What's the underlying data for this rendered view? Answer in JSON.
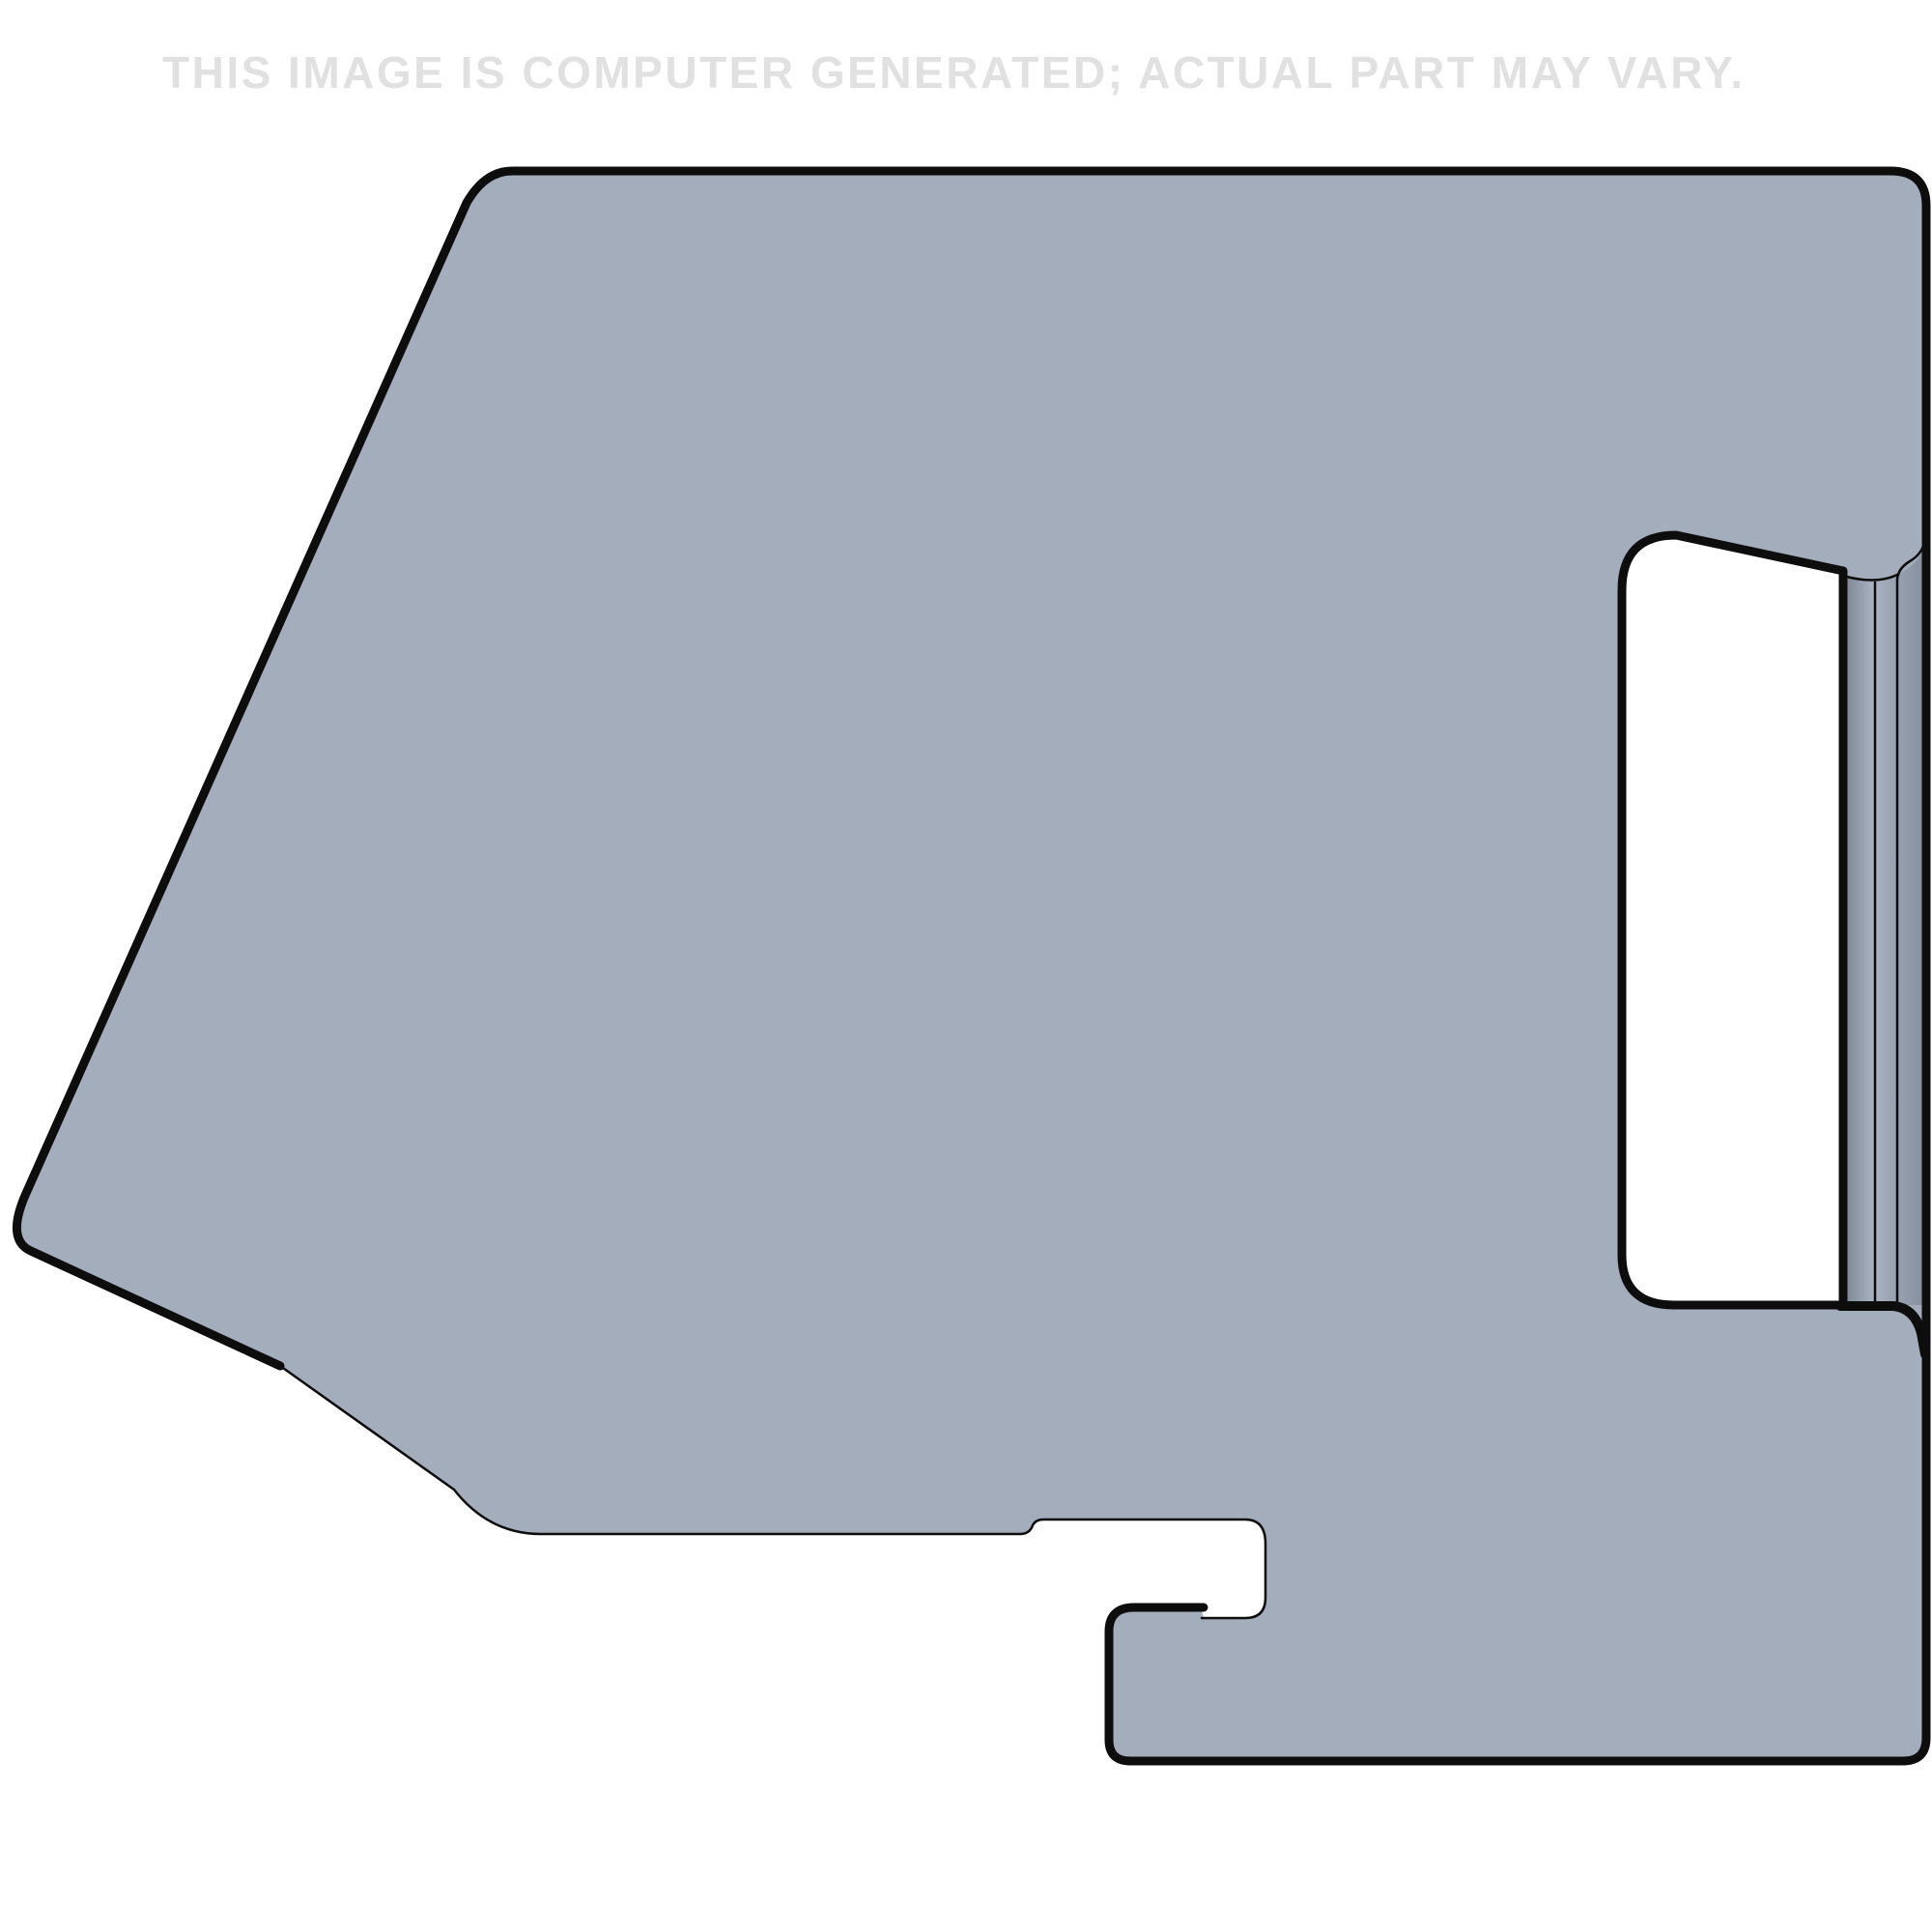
{
  "watermark": {
    "text": "THIS IMAGE IS COMPUTER GENERATED; ACTUAL PART MAY VARY.",
    "color": "#e1e1e1"
  },
  "part": {
    "colors": {
      "background": "#ffffff",
      "face": "#a3adbc",
      "outline": "#0d0d0d",
      "hole_fill": "#ffffff",
      "edge_shadow": "#7d8695",
      "edge_highlight": "#a9b3c1",
      "edge_mid": "#98a2b1",
      "edge_end": "#87909f"
    }
  }
}
